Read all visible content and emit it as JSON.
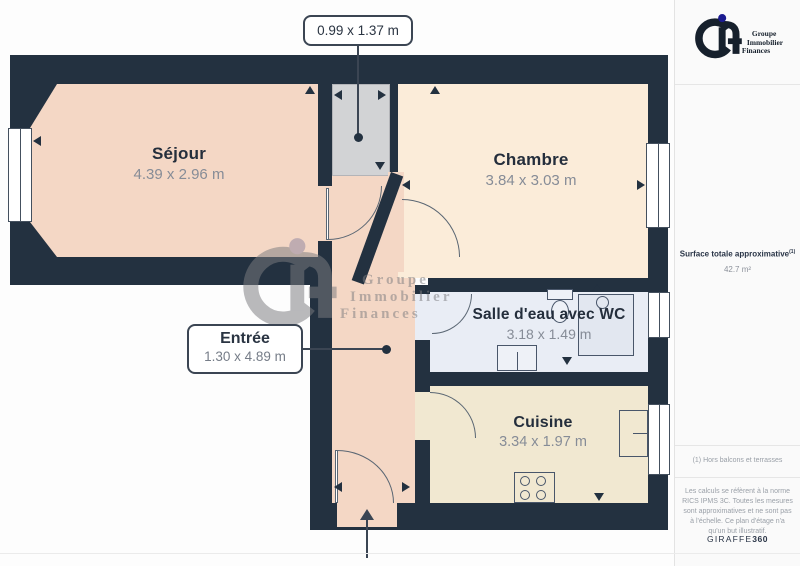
{
  "branding": {
    "logo_lines": [
      "Groupe",
      "Immobilier",
      "Finances"
    ]
  },
  "sidebar": {
    "surface_label": "Surface totale approximative",
    "surface_sup": "(1)",
    "surface_value": "42.7 m²",
    "footnote": "(1) Hors balcons et terrasses",
    "disclaimer": "Les calculs se réfèrent à la norme RICS IPMS 3C. Toutes les mesures sont approximatives et ne sont pas à l'échelle. Ce plan d'étage n'a qu'un but illustratif.",
    "credit_name": "GIRAFFE",
    "credit_suffix": "360"
  },
  "floorplan": {
    "rooms": [
      {
        "id": "sejour",
        "name": "Séjour",
        "dims": "4.39 x 2.96 m",
        "color": "#f4d7c5"
      },
      {
        "id": "chambre",
        "name": "Chambre",
        "dims": "3.84 x 3.03 m",
        "color": "#fbecd9"
      },
      {
        "id": "salle-eau",
        "name": "Salle d'eau avec WC",
        "dims": "3.18 x 1.49 m",
        "color": "#e9edf5"
      },
      {
        "id": "cuisine",
        "name": "Cuisine",
        "dims": "3.34 x 1.97 m",
        "color": "#f1e8d1"
      }
    ],
    "callouts": {
      "closet": {
        "dims": "0.99 x 1.37 m"
      },
      "entree": {
        "name": "Entrée",
        "dims": "1.30 x 4.89 m"
      }
    },
    "colors": {
      "wall": "#233140",
      "closet": "#d2d3d5"
    }
  }
}
